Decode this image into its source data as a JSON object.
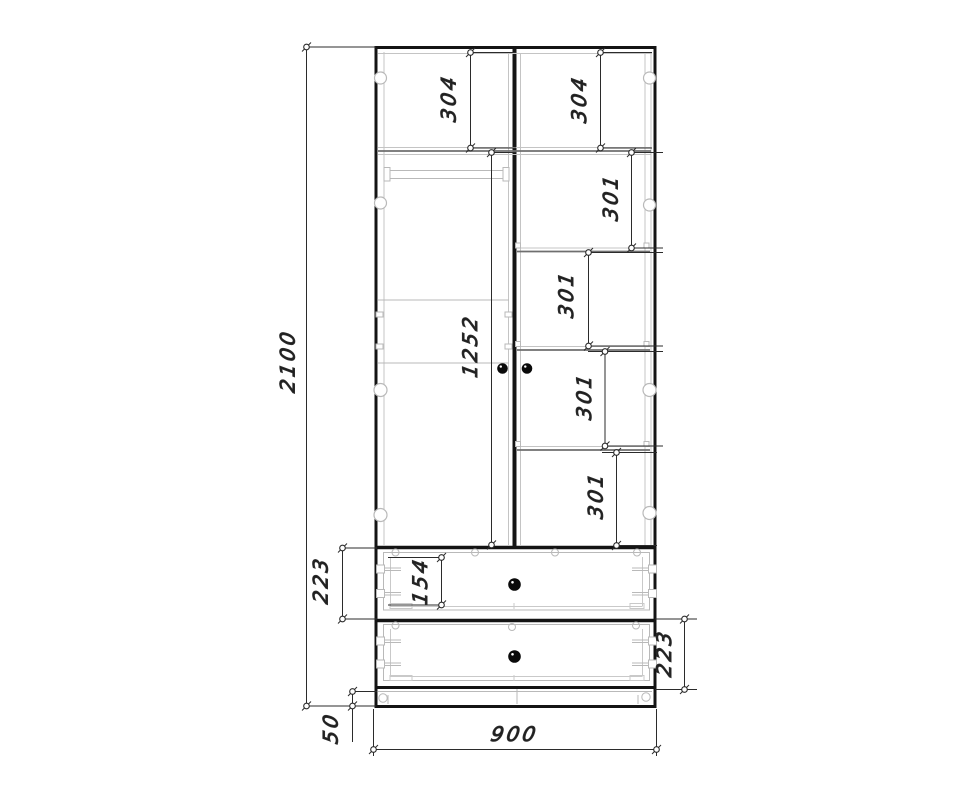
{
  "drawing": {
    "kind": "furniture-front-view-technical-drawing",
    "dims": {
      "overall_height": "2100",
      "overall_width": "900",
      "plinth_height": "50",
      "top_shelf_left": "304",
      "top_shelf_right": "304",
      "right_shelf_1": "301",
      "right_shelf_2": "301",
      "right_shelf_3": "301",
      "right_shelf_4": "301",
      "door_section": "1252",
      "drawer_top_height": "223",
      "drawer_front_height": "154",
      "drawer_bottom_height": "223"
    },
    "colors": {
      "background": "#ffffff",
      "line_strong": "#141414",
      "line_light": "#b9b9b9",
      "dimension_line": "#2b2b2b",
      "knob": "#0a0a0a"
    }
  }
}
